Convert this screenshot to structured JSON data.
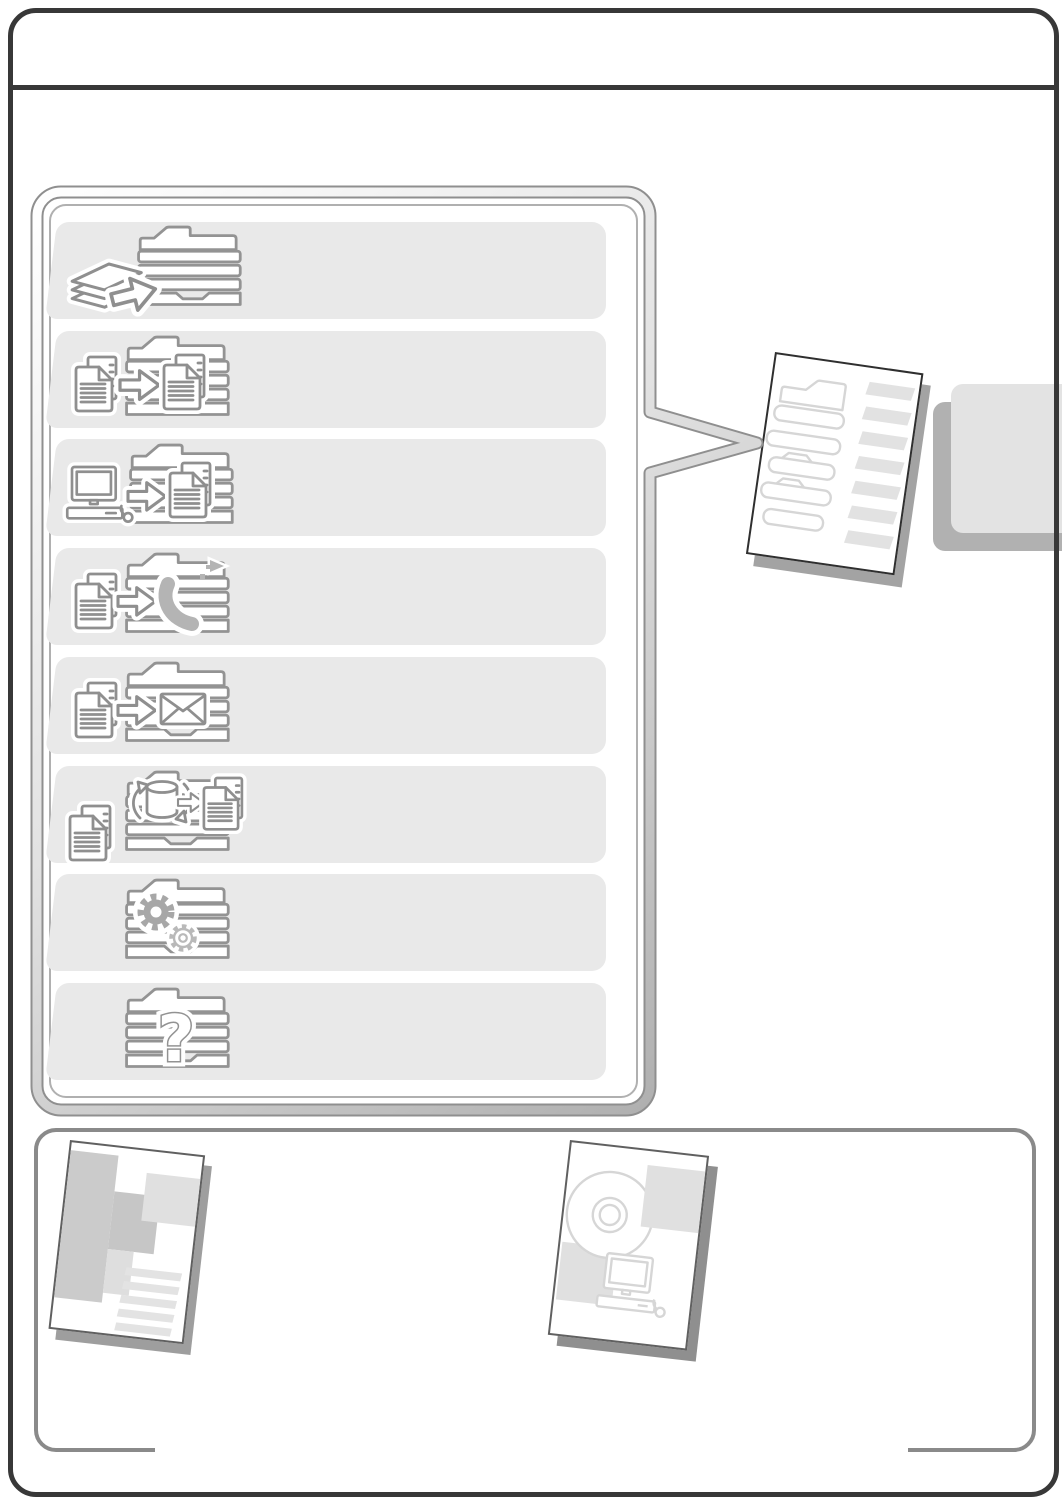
{
  "document": {
    "kind": "operation-guide contents page",
    "visible_text": ""
  },
  "colors": {
    "page_border": "#383838",
    "row_background": "#e9e9e9",
    "icon_stroke": "#8f8f8f",
    "bubble_tube_edge": "#8f8f8f",
    "tab_front": "#e3e3e3",
    "tab_back": "#b1b1b1",
    "bottom_box_border": "#8a8a8a",
    "shadow": "#9e9e9e"
  },
  "bubble": {
    "question_glyph": "?",
    "sections": [
      {
        "id": "before-using-machine",
        "icon": "copier-with-paper-stack-icon"
      },
      {
        "id": "copier",
        "icon": "document-to-document-icon"
      },
      {
        "id": "printer",
        "icon": "computer-to-document-icon"
      },
      {
        "id": "fax",
        "icon": "document-to-telephone-icon"
      },
      {
        "id": "scanner",
        "icon": "document-to-envelope-icon"
      },
      {
        "id": "document-filing",
        "icon": "document-database-icon"
      },
      {
        "id": "system-settings",
        "icon": "gears-icon"
      },
      {
        "id": "troubleshooting",
        "icon": "question-mark-icon"
      }
    ]
  },
  "callout": {
    "points_to": "contents-page-illustration"
  },
  "right_edge": {
    "tabs": [
      "front-tab",
      "back-tab"
    ]
  },
  "bottom_panel": {
    "illustrations": [
      {
        "id": "printed-guide-cover",
        "icon": "abstract-blocks-cover"
      },
      {
        "id": "software-cd-guide-cover",
        "icon": "cd-and-computer-cover"
      }
    ]
  }
}
